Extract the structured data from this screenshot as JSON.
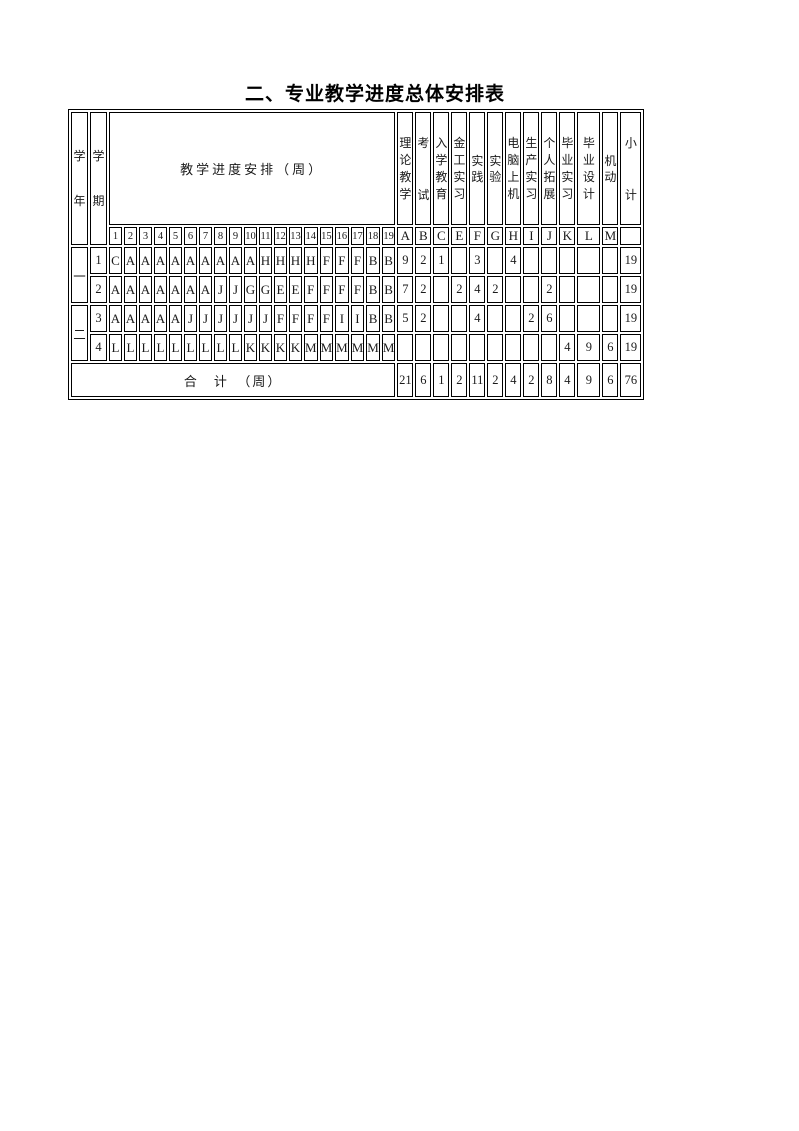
{
  "title": "二、专业教学进度总体安排表",
  "table": {
    "year_header": "学年",
    "semester_header": "学期",
    "progress_header": "教学进度安排（周）",
    "week_numbers": [
      "1",
      "2",
      "3",
      "4",
      "5",
      "6",
      "7",
      "8",
      "9",
      "10",
      "11",
      "12",
      "13",
      "14",
      "15",
      "16",
      "17",
      "18",
      "19"
    ],
    "category_columns": [
      {
        "code": "A",
        "name": "理论教学"
      },
      {
        "code": "B",
        "name": "考试"
      },
      {
        "code": "C",
        "name": "入学教育"
      },
      {
        "code": "E",
        "name": "金工实习"
      },
      {
        "code": "F",
        "name": "实践"
      },
      {
        "code": "G",
        "name": "实验"
      },
      {
        "code": "H",
        "name": "电脑上机"
      },
      {
        "code": "I",
        "name": "生产实习"
      },
      {
        "code": "J",
        "name": "个人拓展"
      },
      {
        "code": "K",
        "name": "毕业实习"
      },
      {
        "code": "L",
        "name": "毕业设计"
      },
      {
        "code": "M",
        "name": "机动"
      }
    ],
    "subtotal_header": "小计",
    "years": [
      {
        "label": "一",
        "row_indexes": [
          0,
          1
        ]
      },
      {
        "label": "二",
        "row_indexes": [
          2,
          3
        ]
      }
    ],
    "rows": [
      {
        "semester": "1",
        "weeks": [
          "C",
          "A",
          "A",
          "A",
          "A",
          "A",
          "A",
          "A",
          "A",
          "A",
          "H",
          "H",
          "H",
          "H",
          "F",
          "F",
          "F",
          "B",
          "B"
        ],
        "counts": [
          "9",
          "2",
          "1",
          "",
          "3",
          "",
          "4",
          "",
          "",
          "",
          "",
          ""
        ],
        "subtotal": "19"
      },
      {
        "semester": "2",
        "weeks": [
          "A",
          "A",
          "A",
          "A",
          "A",
          "A",
          "A",
          "J",
          "J",
          "G",
          "G",
          "E",
          "E",
          "F",
          "F",
          "F",
          "F",
          "B",
          "B"
        ],
        "counts": [
          "7",
          "2",
          "",
          "2",
          "4",
          "2",
          "",
          "",
          "2",
          "",
          "",
          ""
        ],
        "subtotal": "19"
      },
      {
        "semester": "3",
        "weeks": [
          "A",
          "A",
          "A",
          "A",
          "A",
          "J",
          "J",
          "J",
          "J",
          "J",
          "J",
          "F",
          "F",
          "F",
          "F",
          "I",
          "I",
          "B",
          "B"
        ],
        "counts": [
          "5",
          "2",
          "",
          "",
          "4",
          "",
          "",
          "2",
          "6",
          "",
          "",
          ""
        ],
        "subtotal": "19"
      },
      {
        "semester": "4",
        "weeks": [
          "L",
          "L",
          "L",
          "L",
          "L",
          "L",
          "L",
          "L",
          "L",
          "K",
          "K",
          "K",
          "K",
          "M",
          "M",
          "M",
          "M",
          "M",
          "M"
        ],
        "counts": [
          "",
          "",
          "",
          "",
          "",
          "",
          "",
          "",
          "",
          "4",
          "9",
          "6"
        ],
        "subtotal": "19"
      }
    ],
    "total_row": {
      "label": "合　计　（周）",
      "counts": [
        "21",
        "6",
        "1",
        "2",
        "11",
        "2",
        "4",
        "2",
        "8",
        "4",
        "9",
        "6"
      ],
      "total": "76"
    }
  }
}
